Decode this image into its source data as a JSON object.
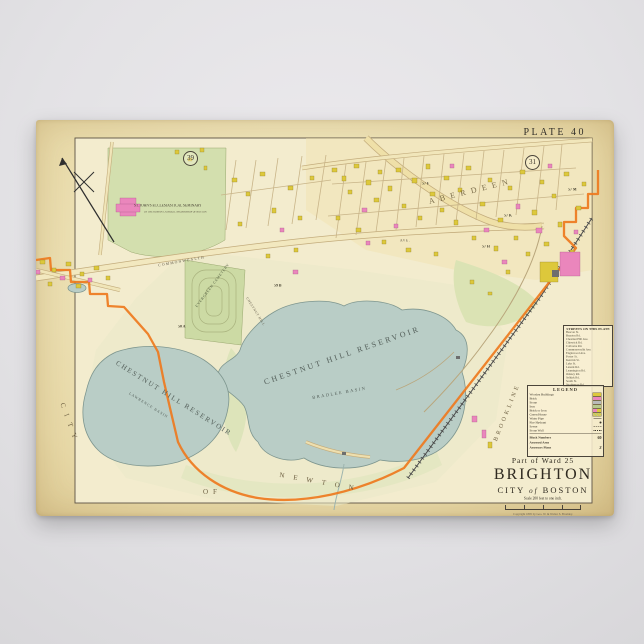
{
  "poster": {
    "plate": "PLATE 40",
    "refs": {
      "left": "39",
      "right": "31"
    }
  },
  "map_labels": {
    "seminary_1": "ST. JOHN'S ECCLESIASTICAL SEMINARY",
    "seminary_2": "OF THE ROMAN CATHOLIC ARCHBISHOP OF BOSTON",
    "cemetery": "EVERGREEN CEMETERY",
    "chestnut_hill_road": "CHESTNUT HILL",
    "commonwealth": "COMMONWEALTH",
    "ave": "AVE.",
    "aberdeen": "ABERDEEN",
    "brookline": "BROOKLINE",
    "reservoir_main": "CHESTNUT HILL RESERVOIR",
    "basin_main": "BRADLEE BASIN",
    "reservoir_west": "CHESTNUT HILL RESERVOIR",
    "basin_west": "LAWRENCE BASIN",
    "city": "CITY",
    "of": "OF",
    "newton": "NEWTON",
    "blocks": [
      "57 F",
      "57 K",
      "57 H",
      "57 M",
      "59 B",
      "50 A"
    ]
  },
  "legend": {
    "title": "LEGEND",
    "items": [
      {
        "label": "Wooden Buildings"
      },
      {
        "label": "Brick"
      },
      {
        "label": "Stone"
      },
      {
        "label": "Iron"
      },
      {
        "label": "Brick or Iron"
      },
      {
        "label": "Green House"
      },
      {
        "label": "Water Pipe"
      },
      {
        "label": "Fire Hydrant"
      },
      {
        "label": "Sewer"
      },
      {
        "label": "Stone Wall"
      }
    ],
    "footer": [
      {
        "label": "Block Numbers",
        "value": "60"
      },
      {
        "label": "Assessed Area",
        "value": ""
      },
      {
        "label": "Assessors Plans",
        "value": "3"
      }
    ]
  },
  "street_index": {
    "title": "STREETS ON THIS PLATE",
    "streets": [
      "Beacon St.",
      "Brayton Rd.",
      "Chestnut Hill Ave.",
      "Chiswick Rd.",
      "Colborne Rd.",
      "Commonwealth Ave.",
      "Englewood Ave.",
      "Foster St.",
      "Kenrick St.",
      "Lake St.",
      "Lanark Rd.",
      "Leamington Rd.",
      "Orkney Rd.",
      "Selkirk Rd.",
      "South St.",
      "Strathmore Rd.",
      "Sutherland Rd.",
      "Wallingford Rd.",
      "Washington St."
    ]
  },
  "title_block": {
    "ward": "Part of Ward 25",
    "name": "BRIGHTON",
    "city_pre": "CITY",
    "city_of": "of",
    "city_post": "BOSTON",
    "scale": "Scale 200 feet to one inch.",
    "publisher": "Copyright 1895 by Geo. W. & Walter S. Bromley."
  },
  "colors": {
    "wooden": "#ddc83b",
    "brick": "#ea86bc",
    "stone": "#b9b9b9",
    "iron": "#b7c98e",
    "water": "#b9cdc6",
    "boundary": "#ee7a1e"
  }
}
